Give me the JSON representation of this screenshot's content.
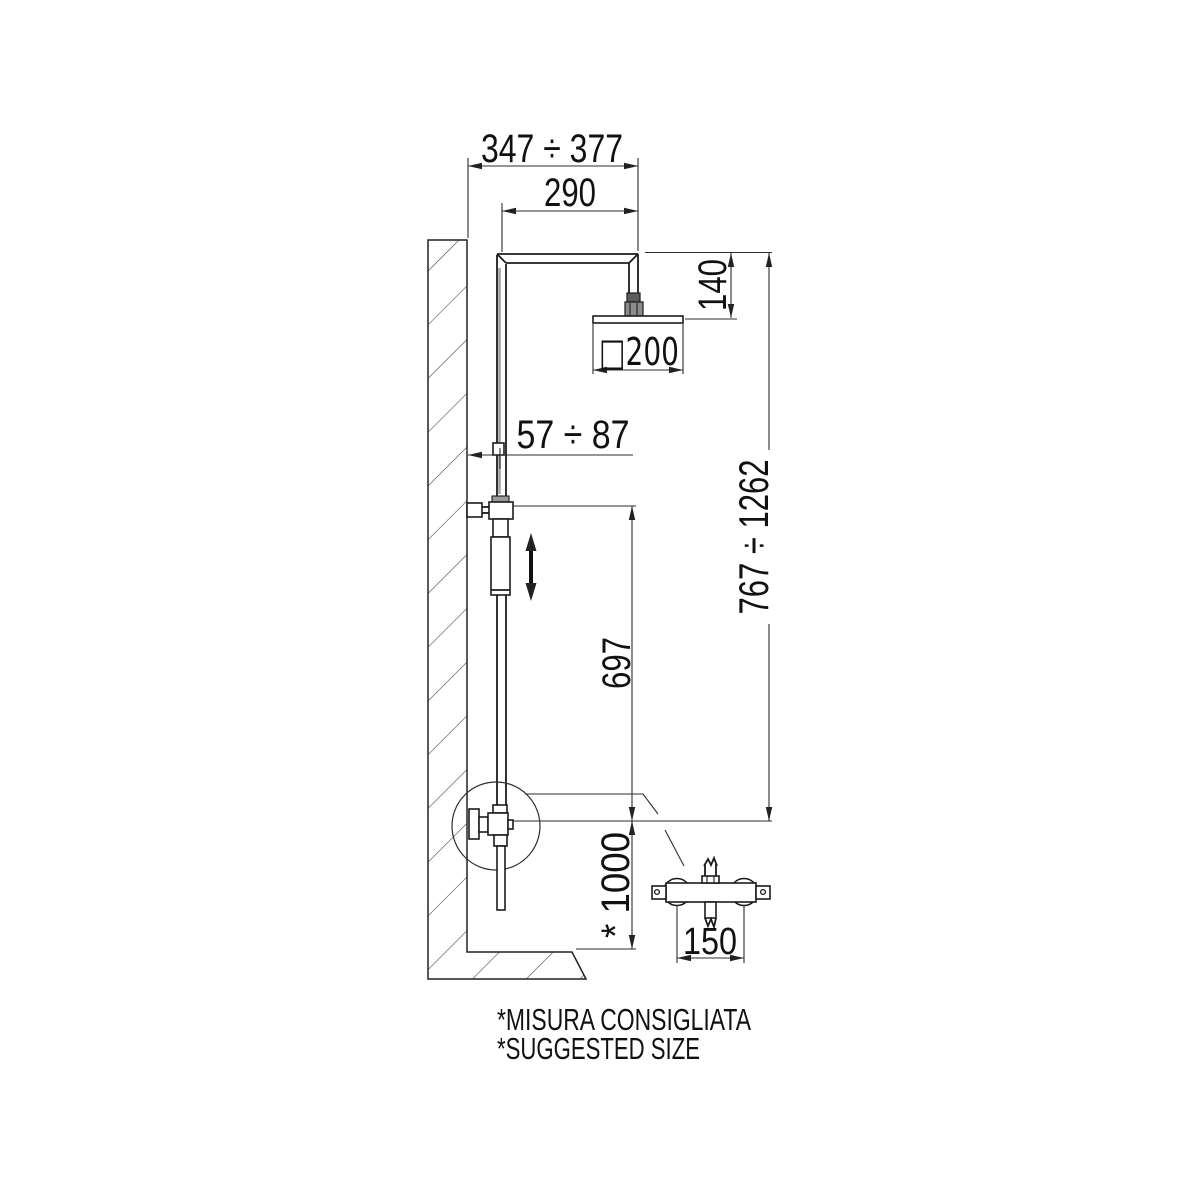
{
  "drawing": {
    "dims": {
      "top_range": "347 ÷ 377",
      "arm_width": "290",
      "head_drop": "140",
      "head_size": "□200",
      "wall_offset": "57 ÷ 87",
      "column_range": "767 ÷ 1262",
      "slide_span": "697",
      "install_height": "* 1000",
      "mixer_centers": "150"
    },
    "notes": {
      "it": "*MISURA CONSIGLIATA",
      "en": "*SUGGESTED SIZE"
    },
    "colors": {
      "line": "#1c1c1c",
      "background": "#ffffff"
    }
  }
}
